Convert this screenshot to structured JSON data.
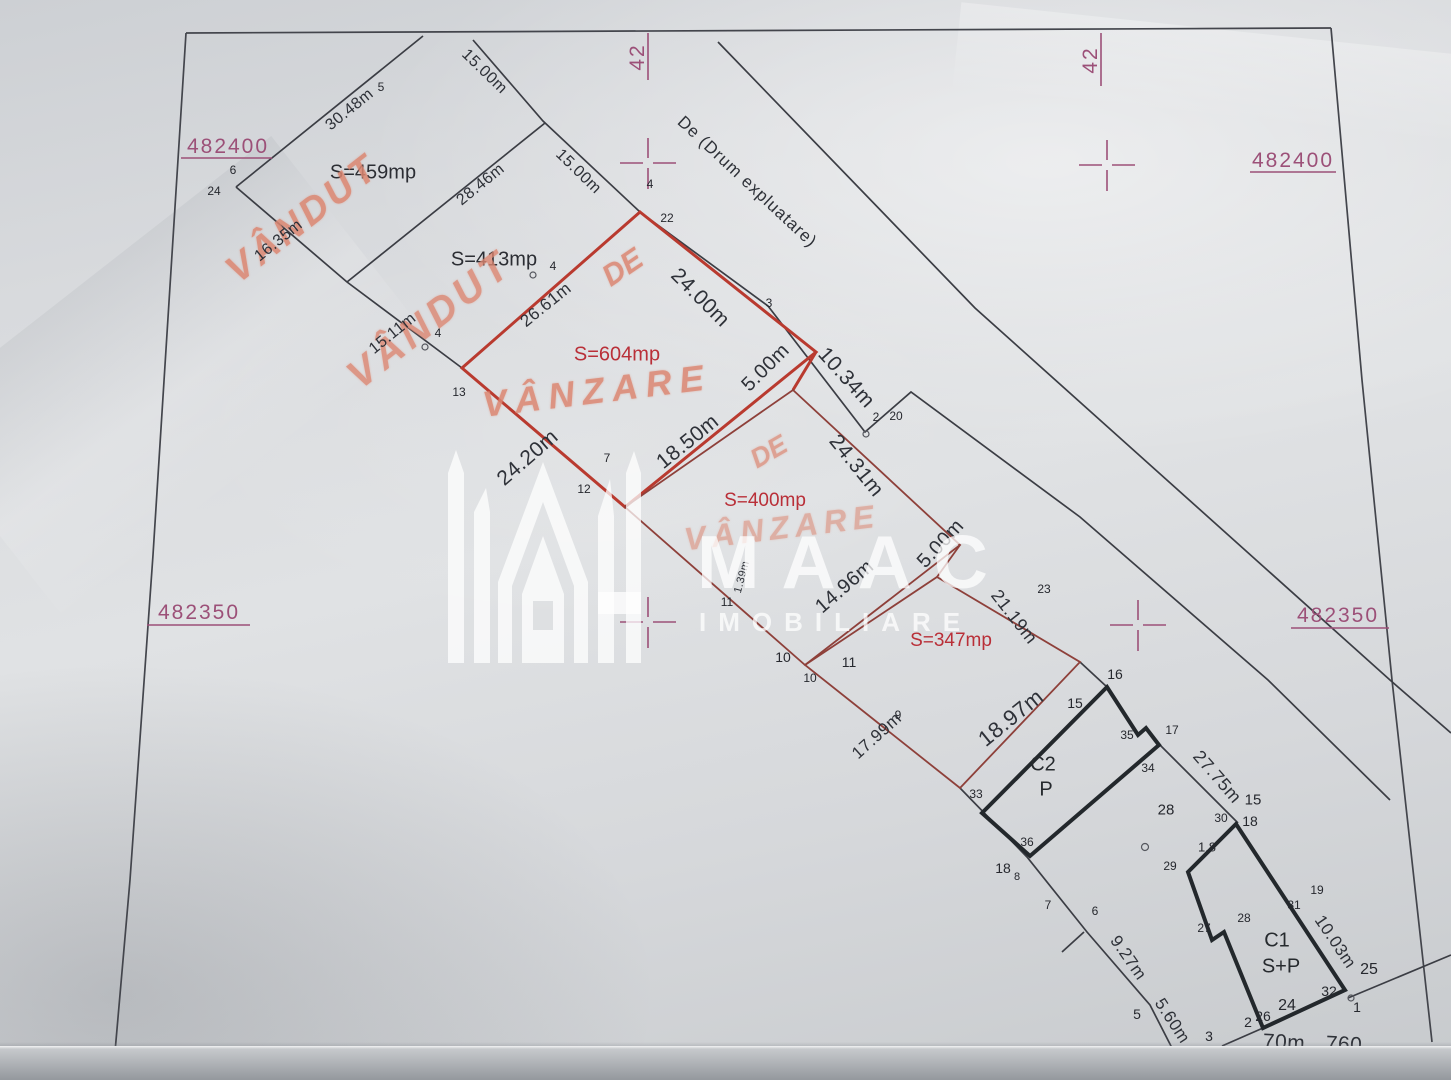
{
  "coordinates": {
    "top_left": "482400",
    "top_right": "482400",
    "mid_left": "482350",
    "mid_right": "482350",
    "grid_top_left": "42",
    "grid_top_right": "42"
  },
  "road_label": "De (Drum expluatare)",
  "areas": [
    "S=459mp",
    "S=413mp",
    "S=604mp",
    "S=400mp",
    "S=347mp"
  ],
  "handwriting": [
    "VÂNDUT",
    "VÂNDUT",
    "DE",
    "VÂNZARE",
    "DE",
    "VÂNZARE"
  ],
  "buildings": {
    "c2": "C2",
    "c2_level": "P",
    "c1": "C1",
    "c1_level": "S+P"
  },
  "dimensions": [
    "30.48m",
    "15.00m",
    "28.46m",
    "15.00m",
    "16.35m",
    "15.11m",
    "26.61m",
    "24.00m",
    "5.00m",
    "10.34m",
    "18.50m",
    "24.20m",
    "24.31m",
    "14.96m",
    "5.00m",
    "21.19m",
    "18.97m",
    "17.99m",
    "27.75m",
    "9.27m",
    "5.60m",
    "10.03m",
    "1.39m",
    "70m",
    "760"
  ],
  "points": [
    "5",
    "6",
    "24",
    "4",
    "22",
    "3",
    "4",
    "4",
    "13",
    "2",
    "20",
    "7",
    "12",
    "11",
    "10",
    "10",
    "11",
    "9",
    "23",
    "16",
    "15",
    "33",
    "36",
    "35",
    "34",
    "17",
    "15",
    "28",
    "30",
    "18",
    "1.8",
    "29",
    "18",
    "8",
    "7",
    "6",
    "27",
    "28",
    "31",
    "19",
    "5",
    "3",
    "2",
    "26",
    "24",
    "32",
    "1",
    "25"
  ],
  "watermark": {
    "brand": "MAAC",
    "tagline": "IMOBILIARE"
  }
}
